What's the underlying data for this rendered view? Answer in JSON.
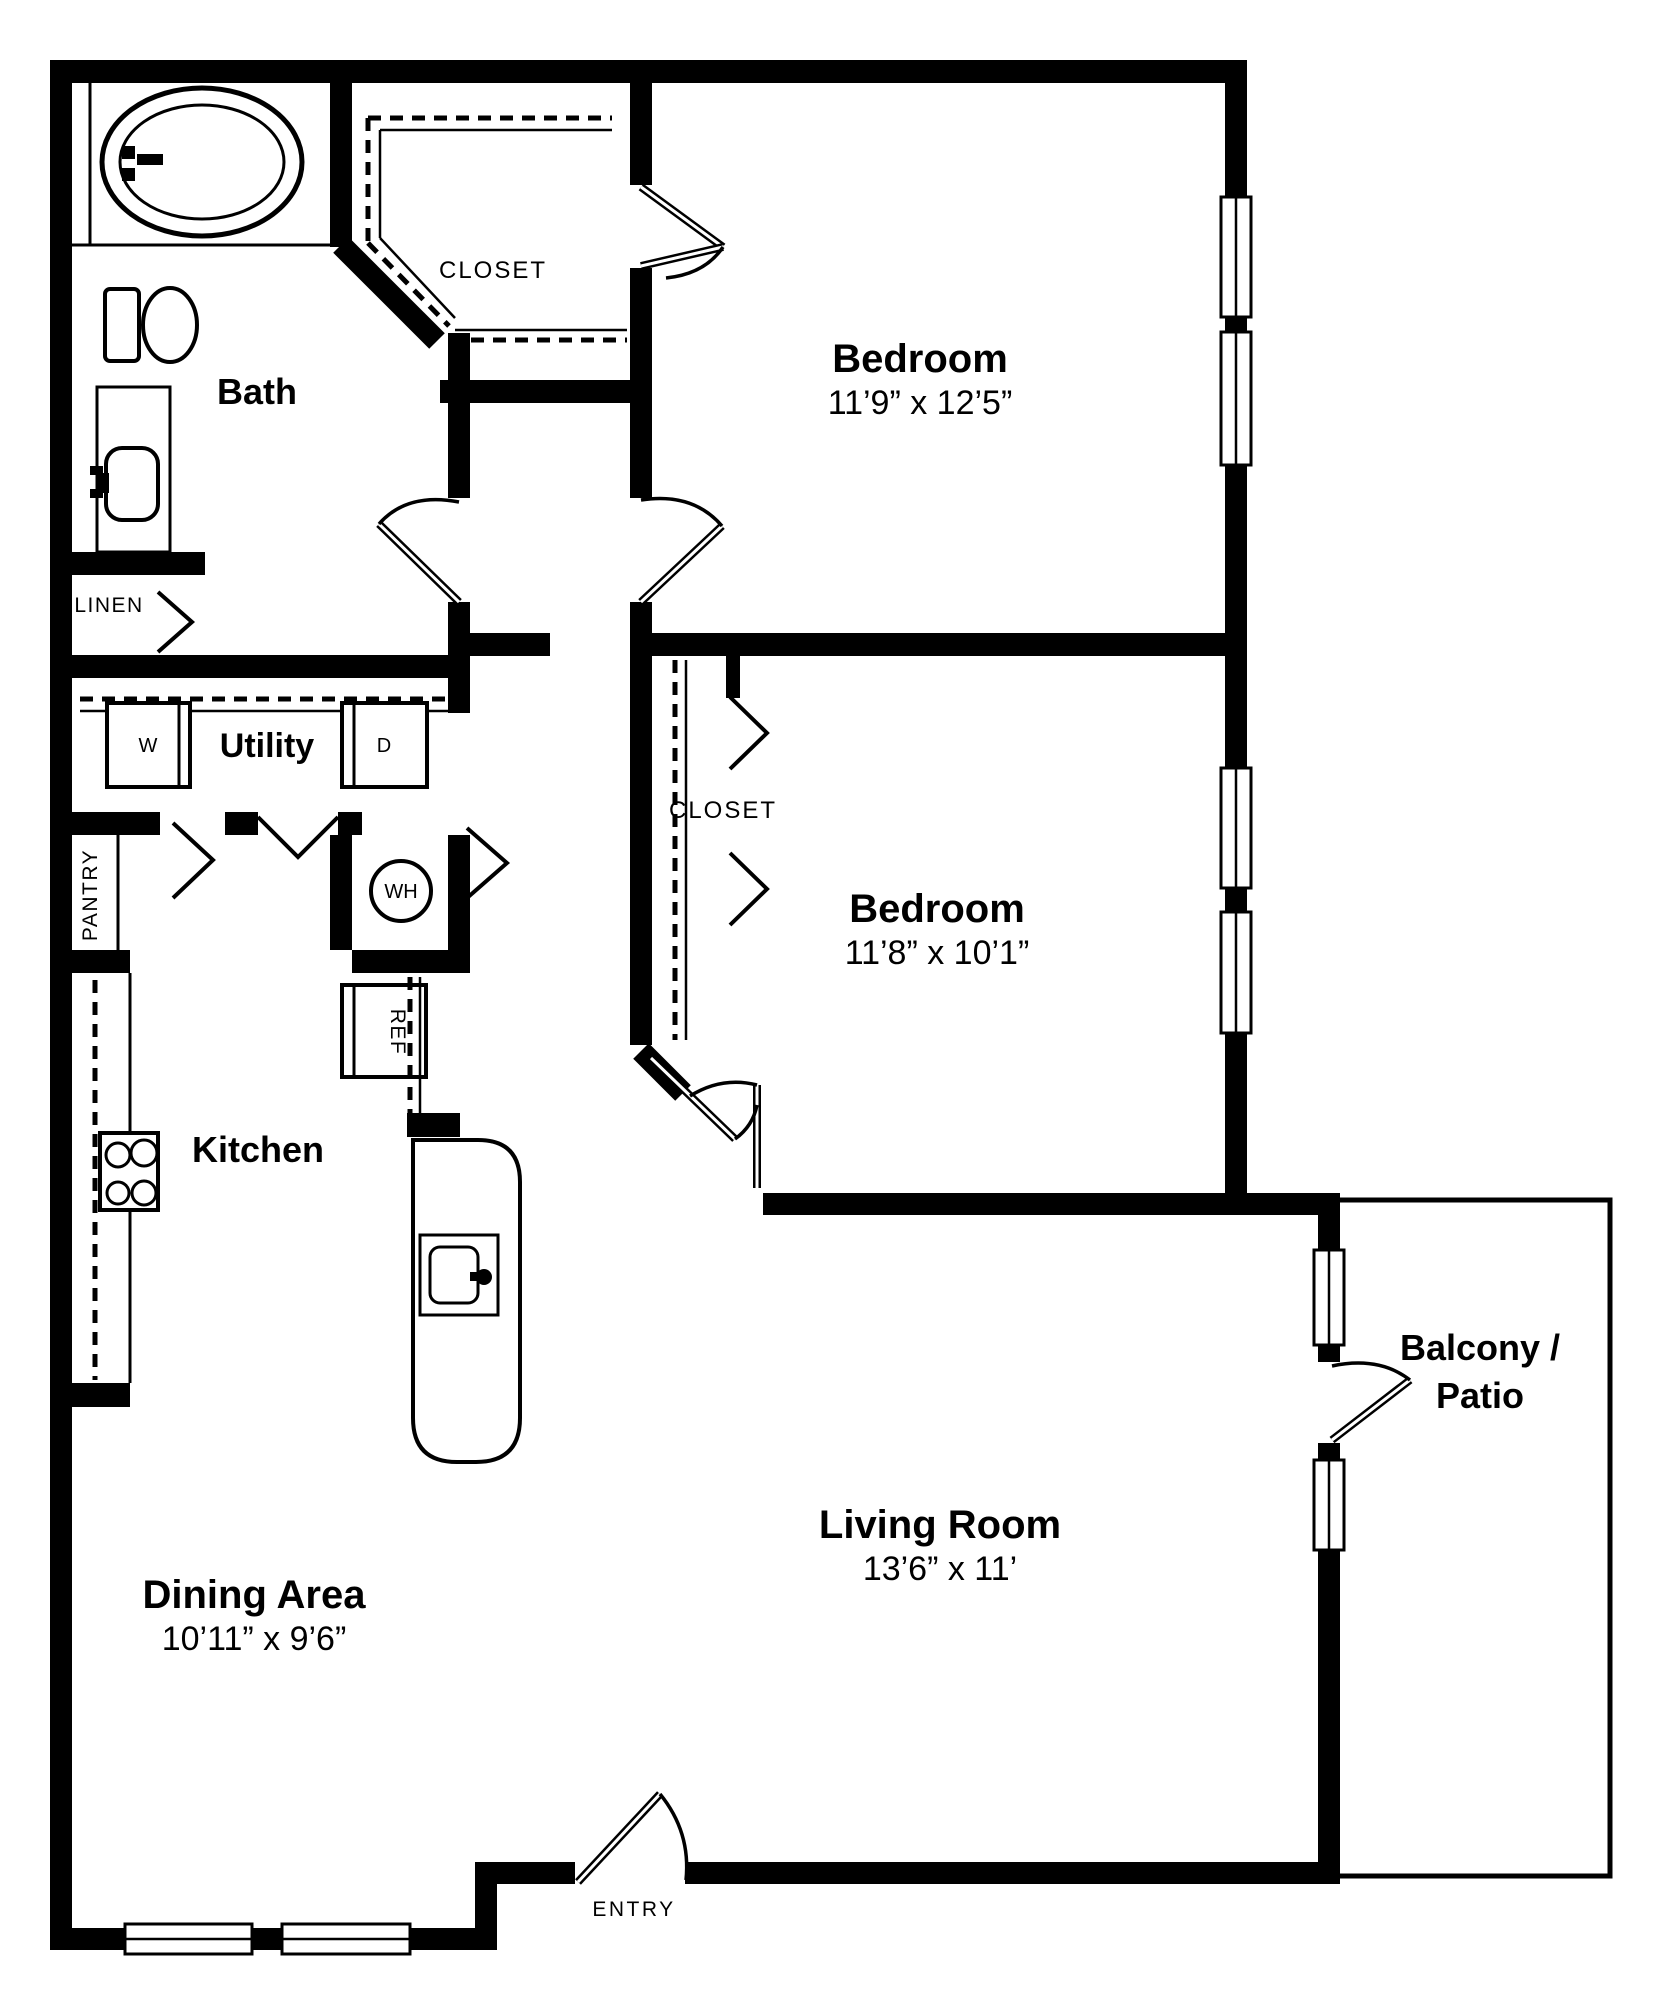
{
  "plan": {
    "bath": {
      "label": "Bath"
    },
    "master_closet": {
      "label": "CLOSET"
    },
    "bedroom1": {
      "label": "Bedroom",
      "dimensions": "11’9” x 12’5”"
    },
    "linen": {
      "label": "LINEN"
    },
    "utility": {
      "label": "Utility",
      "washer": "W",
      "dryer": "D",
      "water_heater": "WH"
    },
    "pantry": {
      "label": "PANTRY"
    },
    "bedroom2": {
      "label": "Bedroom",
      "dimensions": "11’8” x 10’1”",
      "closet": "CLOSET"
    },
    "kitchen": {
      "label": "Kitchen",
      "refrigerator": "REF"
    },
    "dining": {
      "label": "Dining Area",
      "dimensions": "10’11” x 9’6”"
    },
    "living": {
      "label": "Living Room",
      "dimensions": "13’6” x 11’"
    },
    "balcony": {
      "label_line1": "Balcony /",
      "label_line2": "Patio"
    },
    "entry": {
      "label": "ENTRY"
    }
  },
  "colors": {
    "walls": "#000000",
    "background": "#ffffff",
    "text": "#000000"
  }
}
